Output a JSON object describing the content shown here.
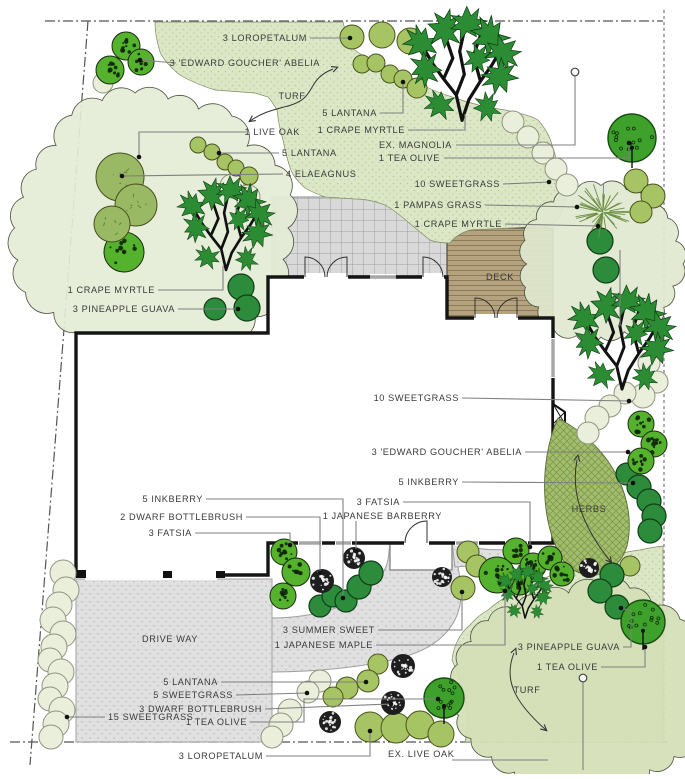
{
  "title": "Landscape plan",
  "colors": {
    "turf": "#dce7c8",
    "turf_dot": "#b9cc92",
    "canopy_tl": "#e4ebd5",
    "canopy_tr": "#dfe8cf",
    "canopy_br": "#d4dfb6",
    "deck": "#b5a37f",
    "deck_line": "#8b7b57",
    "pave": "#e0e0e0",
    "pave_dot": "#b0b0b0",
    "patio": "#d9d9d9",
    "patio_line": "#a0a0a0",
    "herbs": "#a3bd6d",
    "herbs_line": "#7d9a4b",
    "wall": "#151515",
    "leader": "#808080",
    "label": "#3a3a3a",
    "boundary": "#555555",
    "pale": "#e9efdb",
    "pale_edge": "#8f957e",
    "medium": "#a6c464",
    "medium_edge": "#49541d",
    "dark": "#2d8c3b",
    "dark_edge": "#0f3f16",
    "mottled": "#55b22c",
    "speck": "#1e1e1e",
    "teaolive": "#3ea12b",
    "teaolive_edge": "#174d10",
    "elaeagnus": "#9ab964",
    "elaeagnus_edge": "#45501f",
    "branch_leaf": "#2c8c33",
    "branch_wood": "#111111",
    "pampas": "#6d8f46",
    "arrow": "#333333"
  },
  "labels": [
    {
      "id": "loropetalum-top",
      "text": "3 LOROPETALUM",
      "x": 307,
      "y": 41,
      "anchor": "end"
    },
    {
      "id": "abelia-top",
      "text": "3 'EDWARD GOUCHER' ABELIA",
      "x": 320,
      "y": 66,
      "anchor": "end"
    },
    {
      "id": "turf-top",
      "text": "TURF",
      "x": 292,
      "y": 99,
      "anchor": "middle"
    },
    {
      "id": "lantana-top",
      "text": "5 LANTANA",
      "x": 377,
      "y": 116,
      "anchor": "end"
    },
    {
      "id": "crape-myrtle-top",
      "text": "1 CRAPE MYRTLE",
      "x": 405,
      "y": 133,
      "anchor": "end"
    },
    {
      "id": "live-oak",
      "text": "1 LIVE OAK",
      "x": 300,
      "y": 135,
      "anchor": "end"
    },
    {
      "id": "ex-magnolia",
      "text": "EX. MAGNOLIA",
      "x": 452,
      "y": 148,
      "anchor": "end"
    },
    {
      "id": "tea-olive-top",
      "text": "1 TEA  OLIVE",
      "x": 440,
      "y": 161,
      "anchor": "end"
    },
    {
      "id": "lantana-left",
      "text": "5 LANTANA",
      "x": 282,
      "y": 156,
      "anchor": "start"
    },
    {
      "id": "elaeagnus",
      "text": "4 ELAEAGNUS",
      "x": 286,
      "y": 177,
      "anchor": "start"
    },
    {
      "id": "sweetgrass-top",
      "text": "10 SWEETGRASS",
      "x": 500,
      "y": 187,
      "anchor": "end"
    },
    {
      "id": "pampas-grass",
      "text": "1 PAMPAS GRASS",
      "x": 482,
      "y": 208,
      "anchor": "end"
    },
    {
      "id": "crape-myrtle-right",
      "text": "1 CRAPE MYRTLE",
      "x": 502,
      "y": 227,
      "anchor": "end"
    },
    {
      "id": "deck",
      "text": "DECK",
      "x": 500,
      "y": 280,
      "anchor": "middle"
    },
    {
      "id": "crape-myrtle-left",
      "text": "1 CRAPE MYRTLE",
      "x": 155,
      "y": 293,
      "anchor": "end"
    },
    {
      "id": "pineapple-guava-left",
      "text": "3 PINEAPPLE GUAVA",
      "x": 175,
      "y": 312,
      "anchor": "end"
    },
    {
      "id": "sweetgrass-mid",
      "text": "10 SWEETGRASS",
      "x": 459,
      "y": 401,
      "anchor": "end"
    },
    {
      "id": "abelia-mid",
      "text": "3  'EDWARD GOUCHER' ABELIA",
      "x": 522,
      "y": 455,
      "anchor": "end"
    },
    {
      "id": "inkberry-right",
      "text": "5 INKBERRY",
      "x": 459,
      "y": 485,
      "anchor": "end"
    },
    {
      "id": "inkberry-left",
      "text": "5 INKBERRY",
      "x": 203,
      "y": 502,
      "anchor": "end"
    },
    {
      "id": "dwarf-bottlebrush-left",
      "text": "2 DWARF BOTTLEBRUSH",
      "x": 243,
      "y": 520,
      "anchor": "end"
    },
    {
      "id": "fatsia-left",
      "text": "3 FATSIA",
      "x": 192,
      "y": 536,
      "anchor": "end"
    },
    {
      "id": "fatsia-mid",
      "text": "3 FATSIA",
      "x": 400,
      "y": 505,
      "anchor": "end"
    },
    {
      "id": "japanese-barberry",
      "text": "1 JAPANESE BARBERRY",
      "x": 442,
      "y": 519,
      "anchor": "end"
    },
    {
      "id": "herbs",
      "text": "HERBS",
      "x": 589,
      "y": 512,
      "anchor": "middle"
    },
    {
      "id": "driveway",
      "text": "DRIVE WAY",
      "x": 170,
      "y": 642,
      "anchor": "middle"
    },
    {
      "id": "summer-sweet",
      "text": "3 SUMMER SWEET",
      "x": 375,
      "y": 633,
      "anchor": "end"
    },
    {
      "id": "japanese-maple",
      "text": "1 JAPANESE MAPLE",
      "x": 373,
      "y": 648,
      "anchor": "end"
    },
    {
      "id": "pineapple-guava-br",
      "text": "3 PINEAPPLE GUAVA",
      "x": 620,
      "y": 650,
      "anchor": "end"
    },
    {
      "id": "tea-olive-br",
      "text": "1 TEA  OLIVE",
      "x": 598,
      "y": 670,
      "anchor": "end"
    },
    {
      "id": "turf-bottom",
      "text": "TURF",
      "x": 527,
      "y": 693,
      "anchor": "middle"
    },
    {
      "id": "lantana-bottom",
      "text": "5 LANTANA",
      "x": 218,
      "y": 685,
      "anchor": "end"
    },
    {
      "id": "sweetgrass-5",
      "text": "5 SWEETGRASS",
      "x": 233,
      "y": 698,
      "anchor": "end"
    },
    {
      "id": "dwarf-bottlebrush-bottom",
      "text": "3 DWARF BOTTLEBRUSH",
      "x": 262,
      "y": 712,
      "anchor": "end"
    },
    {
      "id": "sweetgrass-15",
      "text": "15 SWEETGRASS",
      "x": 108,
      "y": 720,
      "anchor": "start"
    },
    {
      "id": "tea-olive-bottom",
      "text": "1 TEA  OLIVE",
      "x": 247,
      "y": 725,
      "anchor": "end"
    },
    {
      "id": "loropetalum-bottom",
      "text": "3 LOROPETALUM",
      "x": 263,
      "y": 759,
      "anchor": "end"
    },
    {
      "id": "ex-live-oak",
      "text": "EX. LIVE OAK",
      "x": 388,
      "y": 757,
      "anchor": "start"
    }
  ],
  "leaders": [
    {
      "pts": [
        [
          310,
          38
        ],
        [
          350,
          38
        ]
      ],
      "end": "dot"
    },
    {
      "pts": [
        [
          176,
          63
        ],
        [
          140,
          60
        ]
      ],
      "end": "dot"
    },
    {
      "pts": [
        [
          380,
          113
        ],
        [
          403,
          113
        ],
        [
          403,
          82
        ]
      ],
      "end": "dot"
    },
    {
      "pts": [
        [
          408,
          130
        ],
        [
          465,
          130
        ],
        [
          465,
          114
        ]
      ],
      "end": "none"
    },
    {
      "pts": [
        [
          246,
          132
        ],
        [
          139,
          132
        ],
        [
          139,
          157
        ]
      ],
      "end": "dot"
    },
    {
      "pts": [
        [
          456,
          145
        ],
        [
          575,
          145
        ],
        [
          575,
          76
        ]
      ],
      "end": "circle"
    },
    {
      "pts": [
        [
          444,
          158
        ],
        [
          629,
          158
        ],
        [
          629,
          143
        ]
      ],
      "end": "dot"
    },
    {
      "pts": [
        [
          279,
          153
        ],
        [
          219,
          153
        ]
      ],
      "end": "dot"
    },
    {
      "pts": [
        [
          283,
          174
        ],
        [
          122,
          176
        ]
      ],
      "end": "dot"
    },
    {
      "pts": [
        [
          503,
          184
        ],
        [
          549,
          182
        ]
      ],
      "end": "dot"
    },
    {
      "pts": [
        [
          485,
          205
        ],
        [
          577,
          207
        ]
      ],
      "end": "dot"
    },
    {
      "pts": [
        [
          505,
          224
        ],
        [
          598,
          226
        ]
      ],
      "end": "dot"
    },
    {
      "pts": [
        [
          620,
          250
        ],
        [
          620,
          326
        ]
      ],
      "end": "none"
    },
    {
      "pts": [
        [
          158,
          290
        ],
        [
          223,
          290
        ],
        [
          223,
          266
        ]
      ],
      "end": "none"
    },
    {
      "pts": [
        [
          178,
          309
        ],
        [
          238,
          309
        ]
      ],
      "end": "dot"
    },
    {
      "pts": [
        [
          462,
          398
        ],
        [
          629,
          401
        ]
      ],
      "end": "dot"
    },
    {
      "pts": [
        [
          525,
          452
        ],
        [
          628,
          452
        ]
      ],
      "end": "dot"
    },
    {
      "pts": [
        [
          462,
          482
        ],
        [
          633,
          483
        ]
      ],
      "end": "dot"
    },
    {
      "pts": [
        [
          206,
          499
        ],
        [
          343,
          499
        ],
        [
          343,
          598
        ]
      ],
      "end": "dot"
    },
    {
      "pts": [
        [
          246,
          517
        ],
        [
          320,
          517
        ],
        [
          320,
          573
        ]
      ],
      "end": "dot"
    },
    {
      "pts": [
        [
          195,
          533
        ],
        [
          290,
          533
        ],
        [
          290,
          545
        ]
      ],
      "end": "dot"
    },
    {
      "pts": [
        [
          403,
          502
        ],
        [
          530,
          502
        ],
        [
          530,
          547
        ]
      ],
      "end": "dot"
    },
    {
      "pts": [
        [
          356,
          521
        ],
        [
          356,
          551
        ]
      ],
      "end": "dot"
    },
    {
      "pts": [
        [
          378,
          630
        ],
        [
          462,
          630
        ],
        [
          462,
          592
        ]
      ],
      "end": "dot"
    },
    {
      "pts": [
        [
          376,
          645
        ],
        [
          505,
          645
        ],
        [
          505,
          591
        ]
      ],
      "end": "dot"
    },
    {
      "pts": [
        [
          623,
          647
        ],
        [
          631,
          647
        ],
        [
          631,
          611
        ],
        [
          621,
          608
        ]
      ],
      "end": "dot"
    },
    {
      "pts": [
        [
          601,
          667
        ],
        [
          645,
          667
        ],
        [
          645,
          647
        ]
      ],
      "end": "dot"
    },
    {
      "pts": [
        [
          221,
          682
        ],
        [
          366,
          682
        ]
      ],
      "end": "dot"
    },
    {
      "pts": [
        [
          236,
          695
        ],
        [
          307,
          693
        ]
      ],
      "end": "dot"
    },
    {
      "pts": [
        [
          265,
          709
        ],
        [
          391,
          704
        ]
      ],
      "end": "dot"
    },
    {
      "pts": [
        [
          105,
          717
        ],
        [
          67,
          717
        ]
      ],
      "end": "dot"
    },
    {
      "pts": [
        [
          250,
          722
        ],
        [
          304,
          722
        ],
        [
          304,
          699
        ],
        [
          438,
          699
        ]
      ],
      "end": "dot"
    },
    {
      "pts": [
        [
          266,
          756
        ],
        [
          370,
          756
        ],
        [
          370,
          731
        ]
      ],
      "end": "dot"
    },
    {
      "pts": [
        [
          452,
          760
        ],
        [
          548,
          760
        ]
      ],
      "end": "none"
    },
    {
      "pts": [
        [
          583,
          770
        ],
        [
          583,
          682
        ]
      ],
      "end": "circle"
    }
  ],
  "arrows": [
    {
      "d": "M333,69 C305,80 318,98 288,106 C268,111 260,114 250,121"
    },
    {
      "d": "M514,653 C504,678 512,700 546,730"
    },
    {
      "d": "M577,460 C570,495 585,530 611,562"
    }
  ],
  "plants": {
    "pale": [
      [
        513,
        122,
        11
      ],
      [
        528,
        137,
        11
      ],
      [
        543,
        153,
        11
      ],
      [
        556,
        169,
        11
      ],
      [
        567,
        185,
        11
      ],
      [
        232,
        186,
        12
      ],
      [
        248,
        197,
        12
      ],
      [
        649,
        363,
        11
      ],
      [
        657,
        382,
        11
      ],
      [
        643,
        396,
        12
      ],
      [
        625,
        393,
        11
      ],
      [
        610,
        406,
        11
      ],
      [
        597,
        418,
        12
      ],
      [
        588,
        433,
        11
      ],
      [
        63,
        573,
        13
      ],
      [
        66,
        590,
        13
      ],
      [
        59,
        605,
        13
      ],
      [
        53,
        620,
        13
      ],
      [
        63,
        634,
        13
      ],
      [
        54,
        647,
        13
      ],
      [
        50,
        660,
        12
      ],
      [
        61,
        672,
        13
      ],
      [
        55,
        686,
        13
      ],
      [
        50,
        699,
        12
      ],
      [
        62,
        710,
        13
      ],
      [
        56,
        724,
        13
      ],
      [
        51,
        737,
        12
      ],
      [
        320,
        681,
        11
      ],
      [
        308,
        692,
        11
      ],
      [
        290,
        711,
        12
      ],
      [
        281,
        725,
        12
      ],
      [
        272,
        737,
        11
      ],
      [
        103,
        83,
        10
      ]
    ],
    "medium": [
      [
        352,
        37,
        12
      ],
      [
        382,
        35,
        13
      ],
      [
        410,
        41,
        13
      ],
      [
        362,
        64,
        9
      ],
      [
        376,
        63,
        9
      ],
      [
        390,
        74,
        9
      ],
      [
        403,
        79,
        9
      ],
      [
        417,
        88,
        10
      ],
      [
        198,
        145,
        8
      ],
      [
        212,
        152,
        8
      ],
      [
        225,
        162,
        8
      ],
      [
        236,
        168,
        8
      ],
      [
        249,
        176,
        9
      ],
      [
        636,
        181,
        12
      ],
      [
        653,
        196,
        12
      ],
      [
        641,
        212,
        11
      ],
      [
        378,
        664,
        10
      ],
      [
        368,
        681,
        11
      ],
      [
        347,
        688,
        11
      ],
      [
        333,
        697,
        10
      ],
      [
        370,
        727,
        15
      ],
      [
        396,
        728,
        15
      ],
      [
        420,
        725,
        14
      ],
      [
        441,
        734,
        13
      ],
      [
        468,
        552,
        11
      ],
      [
        477,
        566,
        11
      ],
      [
        463,
        588,
        12
      ],
      [
        630,
        566,
        10
      ]
    ],
    "dark": [
      [
        241,
        287,
        13
      ],
      [
        247,
        308,
        13
      ],
      [
        215,
        309,
        11
      ],
      [
        320,
        606,
        11
      ],
      [
        333,
        596,
        11
      ],
      [
        346,
        601,
        11
      ],
      [
        359,
        587,
        12
      ],
      [
        371,
        573,
        12
      ],
      [
        627,
        474,
        11
      ],
      [
        639,
        487,
        12
      ],
      [
        649,
        501,
        12
      ],
      [
        654,
        516,
        12
      ],
      [
        650,
        531,
        12
      ],
      [
        612,
        575,
        12
      ],
      [
        600,
        591,
        12
      ],
      [
        617,
        607,
        12
      ],
      [
        600,
        241,
        13
      ],
      [
        606,
        270,
        13
      ]
    ],
    "mottled": [
      [
        126,
        46,
        14
      ],
      [
        110,
        70,
        14
      ],
      [
        141,
        62,
        13
      ],
      [
        284,
        552,
        13
      ],
      [
        296,
        572,
        14
      ],
      [
        283,
        596,
        13
      ],
      [
        516,
        551,
        13
      ],
      [
        533,
        566,
        13
      ],
      [
        520,
        583,
        12
      ],
      [
        550,
        558,
        12
      ],
      [
        562,
        574,
        12
      ],
      [
        641,
        424,
        13
      ],
      [
        654,
        444,
        13
      ],
      [
        641,
        461,
        13
      ],
      [
        497,
        575,
        18
      ],
      [
        124,
        252,
        20
      ]
    ],
    "elaeagnus": [
      [
        120,
        177,
        24
      ],
      [
        136,
        205,
        21
      ],
      [
        112,
        224,
        18
      ]
    ],
    "speckdark": [
      [
        322,
        581,
        12
      ],
      [
        354,
        558,
        11
      ],
      [
        442,
        577,
        10
      ],
      [
        589,
        568,
        10
      ],
      [
        403,
        666,
        12
      ],
      [
        393,
        703,
        12
      ],
      [
        330,
        722,
        11
      ]
    ],
    "teaolive": [
      [
        632,
        138,
        24
      ],
      [
        643,
        622,
        22
      ],
      [
        444,
        698,
        20
      ]
    ],
    "pampas": [
      [
        603,
        212,
        30
      ]
    ],
    "branch_trees": [
      [
        462,
        72,
        1.15
      ],
      [
        622,
        345,
        1.05
      ],
      [
        226,
        230,
        0.95
      ],
      [
        525,
        595,
        0.55
      ]
    ]
  },
  "canopies": [
    {
      "name": "live-oak-canopy",
      "cx": 152,
      "cy": 228,
      "rx": 136,
      "ry": 132,
      "bumps": 26,
      "fill": "canopy_tl"
    },
    {
      "name": "crape-myrtle-canopy",
      "cx": 601,
      "cy": 264,
      "rx": 80,
      "ry": 76,
      "bumps": 20,
      "fill": "canopy_tr"
    },
    {
      "name": "ex-live-oak-canopy",
      "cx": 583,
      "cy": 690,
      "rx": 126,
      "ry": 104,
      "bumps": 26,
      "fill": "canopy_br"
    }
  ]
}
